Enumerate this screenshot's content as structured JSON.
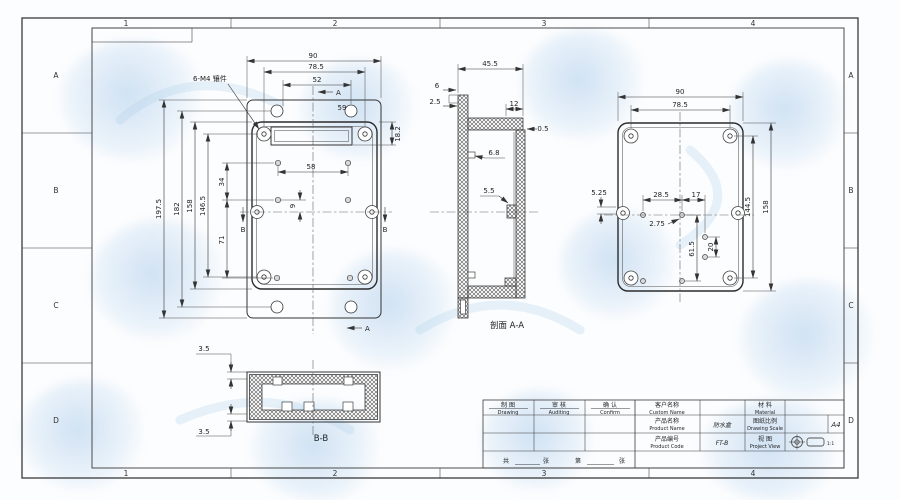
{
  "sheet": {
    "grid_columns": [
      "1",
      "2",
      "3",
      "4"
    ],
    "grid_rows": [
      "A",
      "B",
      "C",
      "D"
    ]
  },
  "callout": {
    "text": "6-M4 镶件"
  },
  "front_view": {
    "section_a": "A",
    "section_b": "B",
    "dims": {
      "overall_w": "90",
      "flange_w": "78.5",
      "slot_w": "52",
      "hole_span": "59",
      "recess_h": "18.2",
      "pitch_x": "58",
      "offset_y": "9",
      "row_gap1": "34",
      "row_gap2": "71",
      "boss_h": "146.5",
      "body_h": "158",
      "hole_h": "182",
      "overall_h": "197.5"
    }
  },
  "section_aa": {
    "label": "剖面 A-A",
    "dims": {
      "depth": "45.5",
      "lip_a": "6",
      "lip_b": "2.5",
      "wall_top": "12",
      "gap": "0.5",
      "rib": "6.8",
      "boss": "5.5"
    }
  },
  "section_bb": {
    "label": "B-B",
    "dims": {
      "lip_top": "3.5",
      "lip_bottom": "3.5"
    }
  },
  "back_view": {
    "dims": {
      "overall_w": "90",
      "hole_w": "78.5",
      "edge_offset": "5.25",
      "pitch_a": "28.5",
      "pitch_b": "17",
      "offset_c": "2.75",
      "pitch_d": "61.5",
      "pitch_e": "20",
      "hole_h": "144.5",
      "overall_h": "158"
    }
  },
  "title_block": {
    "drawing_zh": "制 图",
    "drawing_en": "Drawing",
    "auditing_zh": "审 核",
    "auditing_en": "Auditing",
    "confirm_zh": "确 认",
    "confirm_en": "Confirm",
    "custom_name_zh": "客户名称",
    "custom_name_en": "Custom Name",
    "custom_name_value": "",
    "material_zh": "材 料",
    "material_en": "Material",
    "material_value": "",
    "product_name_zh": "产品名称",
    "product_name_en": "Product Name",
    "product_name_value": "防水盒",
    "scale_zh": "图纸比例",
    "scale_en": "Drawing Scale",
    "scale_value": "",
    "product_code_zh": "产品编号",
    "product_code_en": "Product Code",
    "product_code_value": "FT-B",
    "view_zh": "视 图",
    "view_en": "Project View",
    "paper_size": "A4",
    "projection_note": "1:1",
    "page_row": [
      "共",
      "张",
      "第",
      "张"
    ]
  }
}
